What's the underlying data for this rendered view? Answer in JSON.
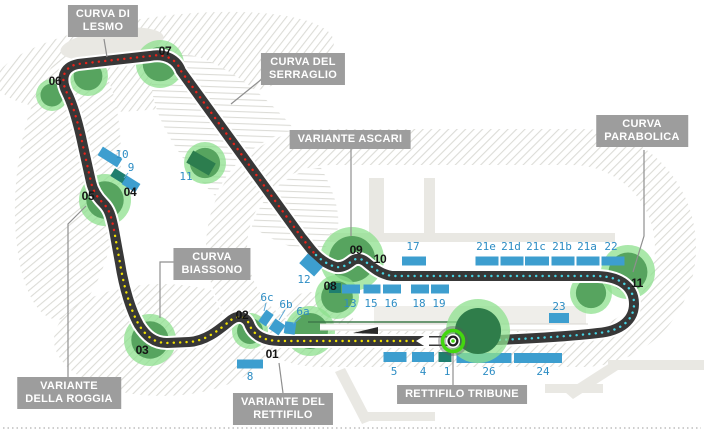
{
  "figure": {
    "kind": "race-circuit-map",
    "direction_arrow": "left",
    "has_start_finish_marker": true,
    "bottom_border": "gray-dotted"
  },
  "colors": {
    "track": "#383838",
    "track_edge": "#ffffff",
    "sector_yellow": "#f0e000",
    "sector_red": "#e8231a",
    "sector_cyan": "#45d2e2",
    "stand_blue": "#3d9ecf",
    "stand_teal": "#1f7e6e",
    "stand_green": "#2c7d4e",
    "stand_label": "#2d8dc4",
    "stand_leader": "#5fa9d6",
    "tree_ring": "#8ee08e",
    "tree_fill": "#57a45f",
    "tree_dark": "#2f7d4a",
    "label_bg": "#9d9d9d",
    "label_text": "#ffffff",
    "corner_text": "#141414",
    "leader": "#8f8f8f",
    "parkland_hatch": "#dcdcd7",
    "road": "#e9e8e3",
    "marker_green": "#43d60f"
  },
  "callouts": [
    {
      "id": "curva-di-lesmo",
      "lines": [
        "CURVA DI",
        "LESMO"
      ],
      "cx": 103,
      "top": 5,
      "leader": [
        [
          104,
          39
        ],
        [
          107,
          57
        ]
      ]
    },
    {
      "id": "curva-del-serraglio",
      "lines": [
        "CURVA DEL",
        "SERRAGLIO"
      ],
      "cx": 303,
      "top": 53,
      "leader": [
        [
          268,
          74
        ],
        [
          231,
          104
        ]
      ]
    },
    {
      "id": "variante-ascari",
      "lines": [
        "VARIANTE  ASCARI"
      ],
      "cx": 350,
      "top": 130,
      "leader": [
        [
          351,
          148
        ],
        [
          351,
          236
        ]
      ]
    },
    {
      "id": "curva-parabolica",
      "lines": [
        "CURVA",
        "PARABOLICA"
      ],
      "cx": 642,
      "top": 115,
      "leader": [
        [
          644,
          150
        ],
        [
          644,
          236
        ],
        [
          633,
          272
        ]
      ]
    },
    {
      "id": "curva-biassono",
      "lines": [
        "CURVA",
        "BIASSONO"
      ],
      "cx": 212,
      "top": 248,
      "leader": [
        [
          180,
          262
        ],
        [
          160,
          262
        ],
        [
          160,
          318
        ]
      ]
    },
    {
      "id": "variante-della-roggia",
      "lines": [
        "VARIANTE",
        "DELLA ROGGIA"
      ],
      "cx": 69,
      "top": 377,
      "leader": [
        [
          68,
          377
        ],
        [
          68,
          224
        ],
        [
          86,
          206
        ]
      ]
    },
    {
      "id": "variante-del-rettifilo",
      "lines": [
        "VARIANTE DEL",
        "RETTIFILO"
      ],
      "cx": 283,
      "top": 393,
      "leader": [
        [
          283,
          393
        ],
        [
          279,
          363
        ]
      ]
    },
    {
      "id": "rettifilo-tribune",
      "lines": [
        "RETTIFILO TRIBUNE"
      ],
      "cx": 462,
      "top": 385,
      "leader": [
        [
          453,
          385
        ],
        [
          453,
          353
        ]
      ]
    }
  ],
  "corners": [
    {
      "num": "01",
      "x": 272,
      "y": 354
    },
    {
      "num": "02",
      "x": 242,
      "y": 315
    },
    {
      "num": "03",
      "x": 142,
      "y": 350
    },
    {
      "num": "04",
      "x": 130,
      "y": 192
    },
    {
      "num": "05",
      "x": 88,
      "y": 196
    },
    {
      "num": "06",
      "x": 55,
      "y": 81
    },
    {
      "num": "07",
      "x": 165,
      "y": 51
    },
    {
      "num": "08",
      "x": 330,
      "y": 286
    },
    {
      "num": "09",
      "x": 356,
      "y": 250
    },
    {
      "num": "10",
      "x": 380,
      "y": 259
    },
    {
      "num": "11",
      "x": 637,
      "y": 283
    }
  ],
  "grandstands": [
    {
      "id": "10",
      "label": "10",
      "lx": 122,
      "ly": 158,
      "parts": [
        {
          "cx": 110,
          "cy": 157,
          "w": 23,
          "h": 10,
          "rot": 32
        }
      ]
    },
    {
      "id": "9",
      "label": "9",
      "lx": 131,
      "ly": 171,
      "leader": [
        [
          128,
          173
        ],
        [
          124,
          178
        ]
      ],
      "parts": [
        {
          "cx": 119,
          "cy": 176,
          "w": 15,
          "h": 9,
          "rot": 32,
          "color": "teal"
        },
        {
          "cx": 131,
          "cy": 184,
          "w": 16,
          "h": 10,
          "rot": 32
        }
      ]
    },
    {
      "id": "11",
      "label": "11",
      "lx": 186,
      "ly": 180,
      "color": "green",
      "parts": [
        {
          "cx": 201,
          "cy": 163,
          "w": 26,
          "h": 14,
          "rot": 30
        }
      ]
    },
    {
      "id": "12",
      "label": "12",
      "lx": 304,
      "ly": 283,
      "parts": [
        {
          "cx": 311,
          "cy": 265,
          "w": 20,
          "h": 13,
          "rot": 42
        }
      ]
    },
    {
      "id": "6c",
      "label": "6c",
      "lx": 267,
      "ly": 301,
      "leader": [
        [
          266,
          303
        ],
        [
          264,
          311
        ]
      ],
      "parts": [
        {
          "cx": 266,
          "cy": 318,
          "w": 9,
          "h": 14,
          "rot": 35
        }
      ]
    },
    {
      "id": "6b",
      "label": "6b",
      "lx": 286,
      "ly": 308,
      "leader": [
        [
          285,
          310
        ],
        [
          279,
          320
        ]
      ],
      "parts": [
        {
          "cx": 277,
          "cy": 327,
          "w": 12,
          "h": 12,
          "rot": 35
        }
      ]
    },
    {
      "id": "6a",
      "label": "6a",
      "lx": 303,
      "ly": 315,
      "leader": [
        [
          301,
          317
        ],
        [
          293,
          324
        ]
      ],
      "parts": [
        {
          "cx": 290,
          "cy": 328,
          "w": 11,
          "h": 12,
          "rot": 8
        }
      ]
    },
    {
      "id": "8",
      "label": "8",
      "lx": 250,
      "ly": 380,
      "parts": [
        {
          "cx": 250,
          "cy": 364,
          "w": 26,
          "h": 9,
          "rot": 0
        }
      ]
    },
    {
      "id": "13",
      "label": "13",
      "lx": 350,
      "ly": 307,
      "parts": [
        {
          "cx": 335,
          "cy": 288,
          "w": 12,
          "h": 10,
          "rot": 0,
          "color": "teal"
        },
        {
          "cx": 351,
          "cy": 289,
          "w": 18,
          "h": 9,
          "rot": 0
        }
      ]
    },
    {
      "id": "15",
      "label": "15",
      "lx": 371,
      "ly": 307,
      "parts": [
        {
          "cx": 372,
          "cy": 289,
          "w": 17,
          "h": 9,
          "rot": 0
        }
      ]
    },
    {
      "id": "16",
      "label": "16",
      "lx": 391,
      "ly": 307,
      "parts": [
        {
          "cx": 392,
          "cy": 289,
          "w": 18,
          "h": 9,
          "rot": 0
        }
      ]
    },
    {
      "id": "18",
      "label": "18",
      "lx": 419,
      "ly": 307,
      "parts": [
        {
          "cx": 420,
          "cy": 289,
          "w": 18,
          "h": 9,
          "rot": 0
        }
      ]
    },
    {
      "id": "19",
      "label": "19",
      "lx": 439,
      "ly": 307,
      "parts": [
        {
          "cx": 440,
          "cy": 289,
          "w": 18,
          "h": 9,
          "rot": 0
        }
      ]
    },
    {
      "id": "17",
      "label": "17",
      "lx": 413,
      "ly": 250,
      "parts": [
        {
          "cx": 414,
          "cy": 261,
          "w": 24,
          "h": 9,
          "rot": 0
        }
      ]
    },
    {
      "id": "21e",
      "label": "21e",
      "lx": 486,
      "ly": 250,
      "parts": [
        {
          "cx": 487,
          "cy": 261,
          "w": 23,
          "h": 9,
          "rot": 0
        }
      ]
    },
    {
      "id": "21d",
      "label": "21d",
      "lx": 511,
      "ly": 250,
      "parts": [
        {
          "cx": 512,
          "cy": 261,
          "w": 23,
          "h": 9,
          "rot": 0
        }
      ]
    },
    {
      "id": "21c",
      "label": "21c",
      "lx": 536,
      "ly": 250,
      "parts": [
        {
          "cx": 537,
          "cy": 261,
          "w": 24,
          "h": 9,
          "rot": 0
        }
      ]
    },
    {
      "id": "21b",
      "label": "21b",
      "lx": 562,
      "ly": 250,
      "parts": [
        {
          "cx": 563,
          "cy": 261,
          "w": 23,
          "h": 9,
          "rot": 0
        }
      ]
    },
    {
      "id": "21a",
      "label": "21a",
      "lx": 587,
      "ly": 250,
      "parts": [
        {
          "cx": 588,
          "cy": 261,
          "w": 23,
          "h": 9,
          "rot": 0
        }
      ]
    },
    {
      "id": "22",
      "label": "22",
      "lx": 611,
      "ly": 250,
      "parts": [
        {
          "cx": 613,
          "cy": 261,
          "w": 23,
          "h": 9,
          "rot": 0
        }
      ]
    },
    {
      "id": "23",
      "label": "23",
      "lx": 559,
      "ly": 310,
      "parts": [
        {
          "cx": 559,
          "cy": 318,
          "w": 20,
          "h": 10,
          "rot": 0
        }
      ]
    },
    {
      "id": "5",
      "label": "5",
      "lx": 394,
      "ly": 375,
      "parts": [
        {
          "cx": 395,
          "cy": 357,
          "w": 23,
          "h": 10,
          "rot": 0
        }
      ]
    },
    {
      "id": "4",
      "label": "4",
      "lx": 423,
      "ly": 375,
      "parts": [
        {
          "cx": 423,
          "cy": 357,
          "w": 22,
          "h": 10,
          "rot": 0
        }
      ]
    },
    {
      "id": "1",
      "label": "1",
      "lx": 447,
      "ly": 375,
      "parts": [
        {
          "cx": 445,
          "cy": 357,
          "w": 13,
          "h": 10,
          "rot": 0,
          "color": "teal"
        }
      ]
    },
    {
      "id": "26",
      "label": "26",
      "lx": 489,
      "ly": 375,
      "parts": [
        {
          "cx": 484,
          "cy": 358,
          "w": 55,
          "h": 10,
          "rot": 0
        }
      ]
    },
    {
      "id": "24",
      "label": "24",
      "lx": 543,
      "ly": 375,
      "parts": [
        {
          "cx": 538,
          "cy": 358,
          "w": 48,
          "h": 10,
          "rot": 0
        }
      ]
    }
  ],
  "trees": [
    {
      "cx": 88,
      "cy": 76,
      "r": 20
    },
    {
      "cx": 160,
      "cy": 64,
      "r": 24
    },
    {
      "cx": 52,
      "cy": 95,
      "r": 16
    },
    {
      "cx": 105,
      "cy": 200,
      "r": 26
    },
    {
      "cx": 205,
      "cy": 163,
      "r": 21
    },
    {
      "cx": 150,
      "cy": 340,
      "r": 26
    },
    {
      "cx": 250,
      "cy": 331,
      "r": 18
    },
    {
      "cx": 352,
      "cy": 259,
      "r": 32
    },
    {
      "cx": 337,
      "cy": 297,
      "r": 22
    },
    {
      "cx": 310,
      "cy": 331,
      "r": 25
    },
    {
      "cx": 478,
      "cy": 331,
      "r": 32,
      "dark": true,
      "top": true
    },
    {
      "cx": 628,
      "cy": 272,
      "r": 27
    },
    {
      "cx": 591,
      "cy": 293,
      "r": 21
    }
  ],
  "sectors": [
    {
      "id": "sector-yellow",
      "color_key": "sector_yellow"
    },
    {
      "id": "sector-red",
      "color_key": "sector_red"
    },
    {
      "id": "sector-cyan",
      "color_key": "sector_cyan"
    }
  ]
}
